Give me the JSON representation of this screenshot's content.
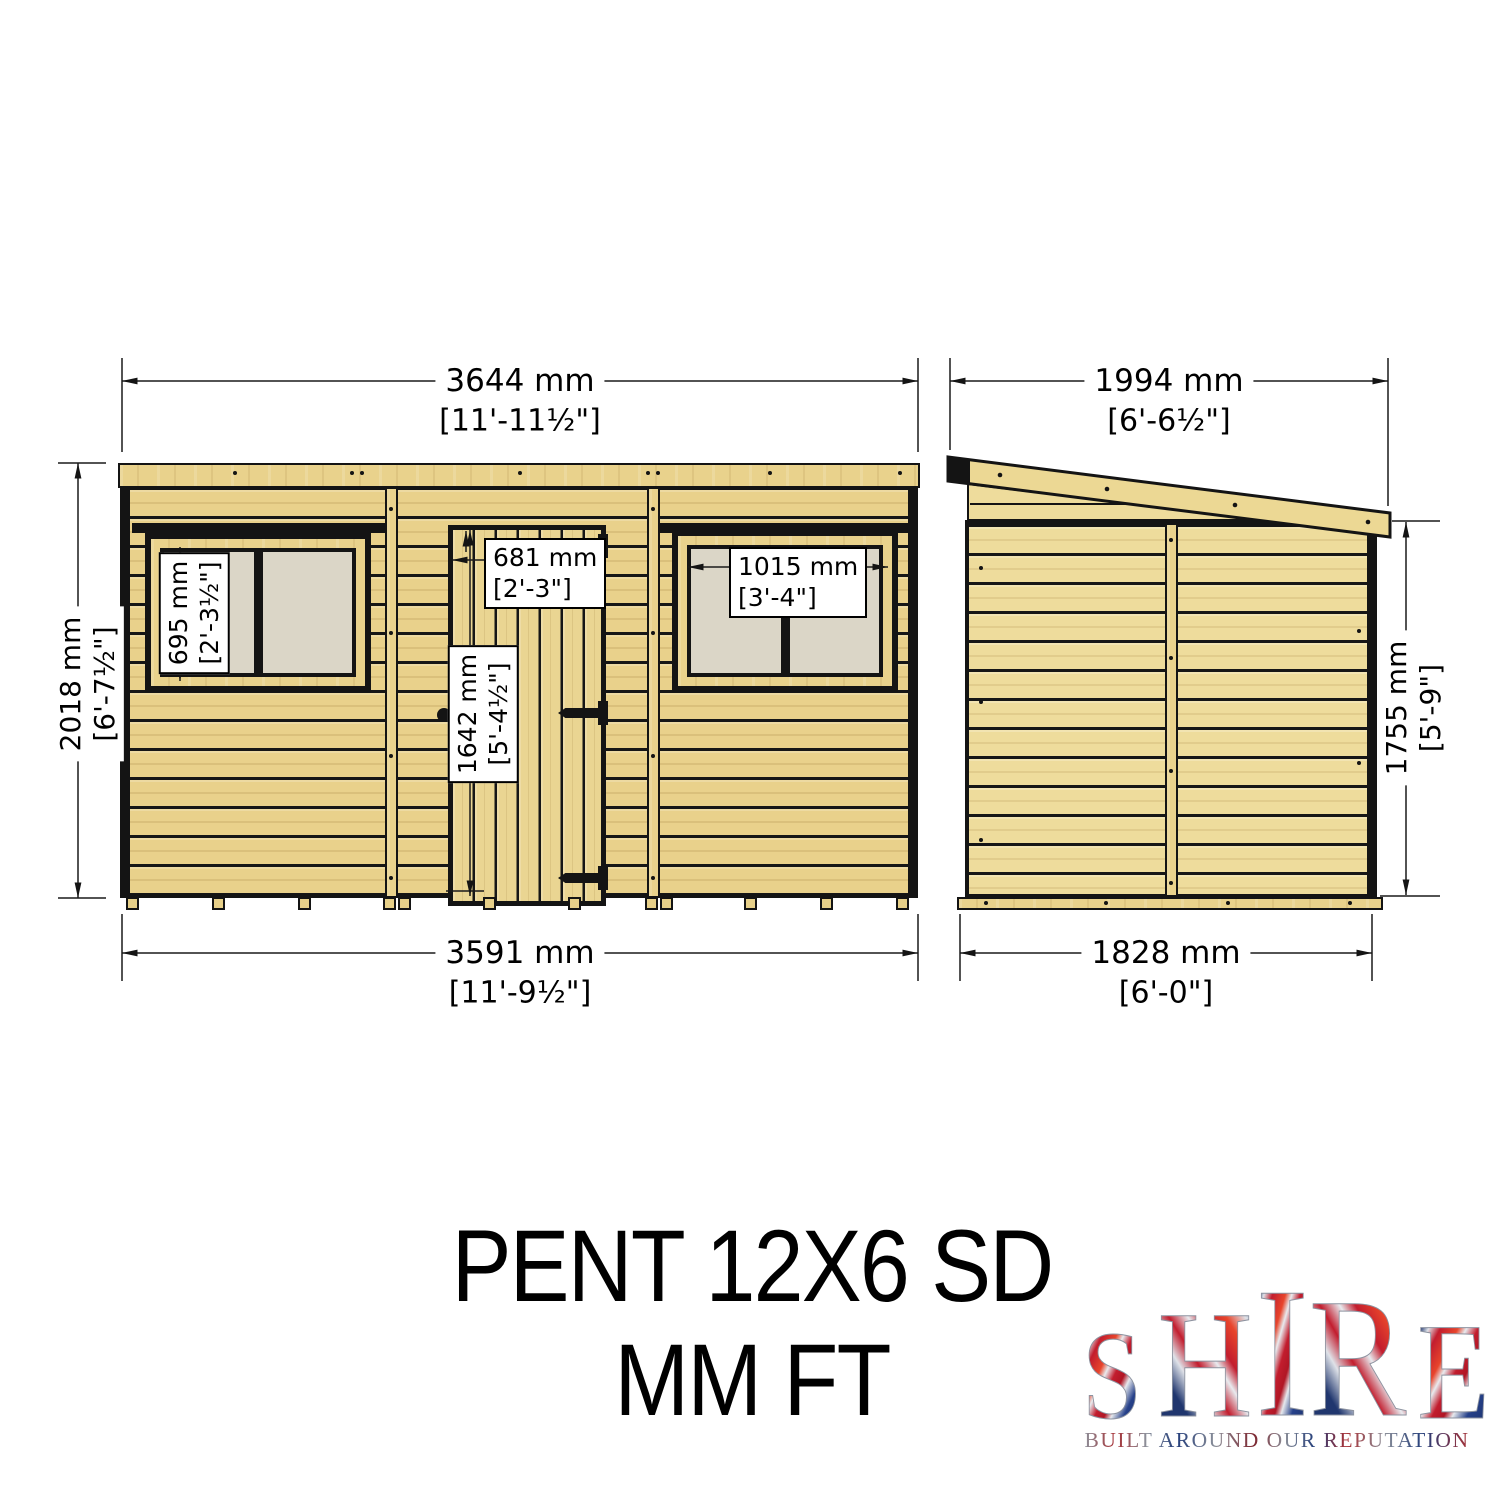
{
  "title": {
    "line1": "PENT 12X6 SD",
    "line2": "MM FT"
  },
  "front_view": {
    "overall_width_mm": "3644 mm",
    "overall_width_ftin": "[11'-11½\"]",
    "overall_height_mm": "2018 mm",
    "overall_height_ftin": "[6'-7½\"]",
    "base_width_mm": "3591 mm",
    "base_width_ftin": "[11'-9½\"]",
    "door_width_mm": "681 mm",
    "door_width_ftin": "[2'-3\"]",
    "door_height_mm": "1642 mm",
    "door_height_ftin": "[5'-4½\"]",
    "left_window_height_mm": "695 mm",
    "left_window_height_ftin": "[2'-3½\"]",
    "right_window_width_mm": "1015 mm",
    "right_window_width_ftin": "[3'-4\"]"
  },
  "side_view": {
    "overall_depth_mm": "1994 mm",
    "overall_depth_ftin": "[6'-6½\"]",
    "eaves_height_mm": "1755 mm",
    "eaves_height_ftin": "[5'-9\"]",
    "base_depth_mm": "1828 mm",
    "base_depth_ftin": "[6'-0\"]"
  },
  "logo": {
    "letters": [
      "S",
      "H",
      "I",
      "R",
      "E"
    ],
    "tagline": "BUILT AROUND OUR REPUTATION"
  },
  "colors": {
    "wood": "#e9d18b",
    "wood_light": "#eedc9c",
    "outline": "#141414",
    "glass": "#dbd6c7",
    "label_bg": "#ffffff",
    "logo_red": "#c21d2e",
    "logo_blue": "#24418c",
    "logo_silver": "#e6e9ed"
  }
}
